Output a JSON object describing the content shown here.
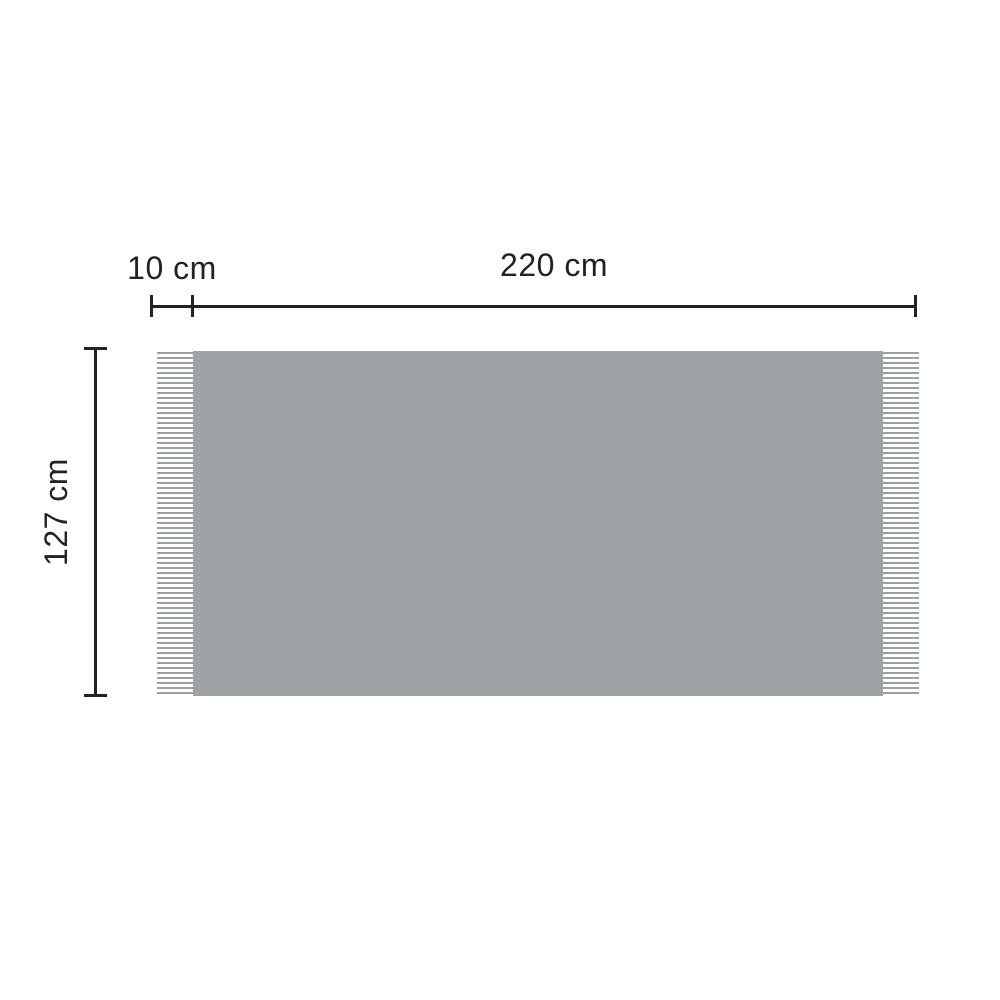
{
  "diagram": {
    "labels": {
      "fringe_width": "10 cm",
      "total_width": "220 cm",
      "height": "127 cm"
    },
    "colors": {
      "background": "#ffffff",
      "blanket_fill": "#9ea3a6",
      "fringe_line": "#9aa0a2",
      "dimension_line": "#222222"
    }
  }
}
